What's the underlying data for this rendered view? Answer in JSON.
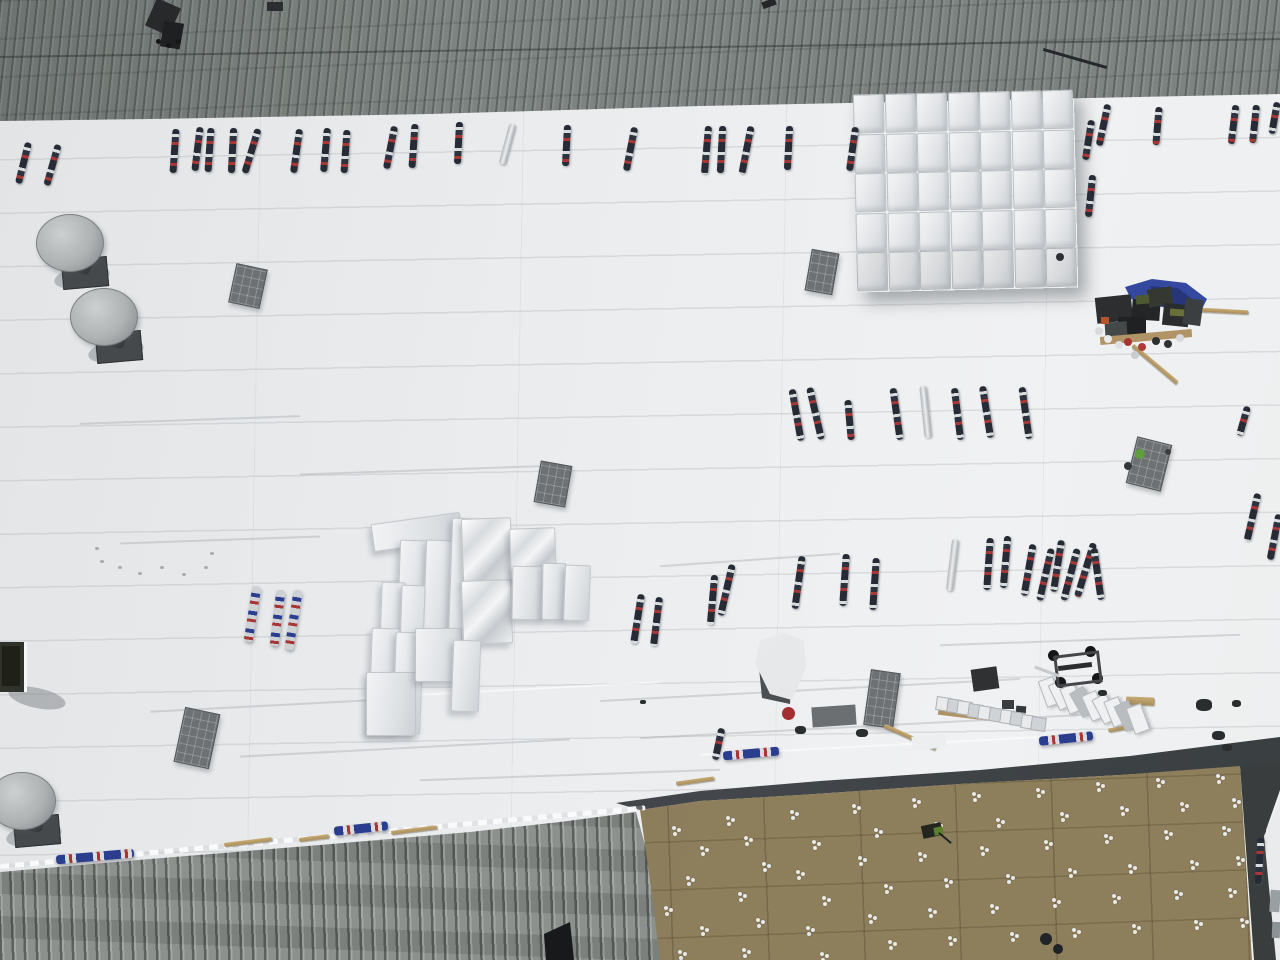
{
  "meta": {
    "view": "aerial-drone-roof-construction",
    "canvas": {
      "w": 1280,
      "h": 960
    }
  },
  "palette": {
    "membrane_white": "#eceeef",
    "metal_gray": "#7d8380",
    "weathered_metal": "#868b88",
    "insulation_tan": "#8d7e5c",
    "dark_membrane": "#3f4344",
    "roll_navy": "#2a3040",
    "roll_red": "#a83434",
    "roll_blue": "#2b3d8f",
    "tarp_blue": "#3448a0",
    "wood_tan": "#b99d66",
    "stack_white": "#eef0f2",
    "pad_gray": "#6d7174",
    "vent_cap_gray": "#b6b9ba",
    "safety_green": "#5f9f3a"
  },
  "scene": {
    "polys": [
      {
        "name": "corrugated-metal-roof-top",
        "pts": "0,0 1280,0 1280,94 1040,99 700,106 430,114 150,119 0,121",
        "cls": "metal-top"
      },
      {
        "name": "corrugated-metal-roof-bottom-left",
        "pts": "0,872 150,859 320,845 470,832 560,822 636,812 648,856 656,900 662,960 0,960",
        "cls": "metal-bottom"
      },
      {
        "name": "dark-membrane-band",
        "pts": "616,803 700,791 820,781 980,770 1130,756 1280,737 1280,765 1120,775 960,784 800,795 700,801 640,810",
        "cls": "dark-band"
      },
      {
        "name": "insulation-board-field",
        "pts": "640,810 700,801 800,795 960,784 1120,775 1240,766 1252,960 660,960 650,880",
        "cls": "tan-field"
      },
      {
        "name": "right-edge-dark-strip",
        "pts": "1240,766 1280,762 1280,790 1266,830 1277,960 1254,960",
        "fill": "#393d3e"
      },
      {
        "name": "right-edge-white-sliver",
        "pts": "1264,836 1280,800 1280,960 1276,960",
        "fill": "#e9ebec"
      },
      {
        "name": "metal-roof-opening",
        "pts": "544,934 570,922 574,960 546,960",
        "fill": "#17191a"
      },
      {
        "name": "white-tarp-shadow",
        "pts": "758,658 792,666 790,704 762,698",
        "fill": "#4b4f51"
      },
      {
        "name": "white-tarp-piece",
        "pts": "760,640 786,633 804,641 806,667 792,700 770,694 755,663",
        "cls": "tarp-light"
      },
      {
        "name": "blue-tarp",
        "pts": "1125,287 1152,279 1186,283 1207,299 1198,317 1172,309 1148,304 1131,299",
        "fill": "#3448a0"
      },
      {
        "name": "blue-tarp-fold",
        "pts": "1150,286 1178,288 1196,302 1180,310 1156,300",
        "fill": "#273579"
      }
    ],
    "streaks": [
      [
        150,
        705,
        260,
        -3
      ],
      [
        240,
        748,
        330,
        -3
      ],
      [
        420,
        775,
        300,
        -2
      ],
      [
        600,
        690,
        420,
        -3
      ],
      [
        640,
        725,
        500,
        -3
      ],
      [
        120,
        540,
        200,
        -2
      ],
      [
        660,
        560,
        180,
        -4
      ],
      [
        940,
        640,
        300,
        -2
      ],
      [
        300,
        470,
        260,
        -2
      ],
      [
        80,
        420,
        220,
        -2
      ]
    ],
    "bright_streaks": [
      [
        360,
        690,
        300,
        -3
      ],
      [
        700,
        745,
        380,
        -3
      ]
    ],
    "rolls": [
      [
        23,
        163,
        42,
        14
      ],
      [
        52,
        165,
        42,
        16
      ],
      [
        174,
        151,
        44,
        4
      ],
      [
        197,
        149,
        44,
        7
      ],
      [
        209,
        150,
        44,
        4
      ],
      [
        232,
        150,
        45,
        3
      ],
      [
        251,
        151,
        46,
        17
      ],
      [
        296,
        151,
        44,
        8
      ],
      [
        325,
        150,
        44,
        5
      ],
      [
        345,
        151,
        43,
        4
      ],
      [
        390,
        147,
        43,
        11
      ],
      [
        413,
        146,
        44,
        4
      ],
      [
        458,
        143,
        42,
        3
      ],
      [
        507,
        144,
        42,
        15,
        "s"
      ],
      [
        566,
        145,
        41,
        3
      ],
      [
        630,
        149,
        44,
        11
      ],
      [
        706,
        150,
        48,
        5
      ],
      [
        721,
        149,
        47,
        3
      ],
      [
        746,
        150,
        48,
        11
      ],
      [
        788,
        148,
        44,
        3
      ],
      [
        852,
        149,
        44,
        8
      ],
      [
        1088,
        140,
        40,
        9
      ],
      [
        1103,
        125,
        42,
        12
      ],
      [
        1090,
        196,
        42,
        6
      ],
      [
        1157,
        126,
        38,
        5
      ],
      [
        1233,
        124,
        39,
        7
      ],
      [
        1254,
        124,
        38,
        6
      ],
      [
        1274,
        118,
        32,
        10
      ],
      [
        796,
        415,
        52,
        -10
      ],
      [
        815,
        413,
        53,
        -13
      ],
      [
        849,
        420,
        40,
        -5
      ],
      [
        896,
        414,
        52,
        -8
      ],
      [
        925,
        412,
        52,
        -6,
        "s"
      ],
      [
        957,
        414,
        52,
        -7
      ],
      [
        986,
        412,
        52,
        -9
      ],
      [
        1025,
        413,
        52,
        -8
      ],
      [
        1243,
        421,
        30,
        16
      ],
      [
        1252,
        517,
        48,
        13
      ],
      [
        1274,
        537,
        46,
        11
      ],
      [
        637,
        619,
        50,
        9
      ],
      [
        656,
        621,
        49,
        7
      ],
      [
        712,
        600,
        50,
        5
      ],
      [
        726,
        590,
        52,
        13
      ],
      [
        798,
        582,
        53,
        8
      ],
      [
        844,
        580,
        52,
        4
      ],
      [
        874,
        584,
        52,
        4
      ],
      [
        952,
        565,
        52,
        7,
        "s"
      ],
      [
        988,
        564,
        52,
        4
      ],
      [
        1005,
        562,
        52,
        5
      ],
      [
        1028,
        570,
        52,
        10
      ],
      [
        1045,
        574,
        53,
        13
      ],
      [
        1057,
        566,
        52,
        9
      ],
      [
        1070,
        574,
        53,
        15
      ],
      [
        1085,
        570,
        56,
        17
      ],
      [
        1097,
        574,
        52,
        -8
      ],
      [
        252,
        614,
        56,
        9,
        "sl"
      ],
      [
        277,
        618,
        56,
        7,
        "sl"
      ],
      [
        293,
        620,
        60,
        9,
        "sl"
      ],
      [
        718,
        744,
        32,
        12
      ],
      [
        751,
        753,
        56,
        -5,
        "tpo"
      ],
      [
        1066,
        738,
        54,
        -6,
        "tpo"
      ],
      [
        95,
        856,
        78,
        -5,
        "tpo"
      ],
      [
        361,
        828,
        54,
        -6,
        "tpo"
      ],
      [
        1259,
        861,
        46,
        4
      ]
    ],
    "pads": [
      [
        232,
        266,
        30,
        38,
        12
      ],
      [
        808,
        251,
        26,
        40,
        10
      ],
      [
        537,
        463,
        30,
        40,
        10
      ],
      [
        179,
        710,
        34,
        54,
        12
      ],
      [
        867,
        671,
        28,
        54,
        8
      ],
      [
        1131,
        440,
        34,
        46,
        14
      ]
    ],
    "vents": [
      [
        36,
        214
      ],
      [
        70,
        288
      ],
      [
        -12,
        772
      ]
    ],
    "stack_large": {
      "x": 855,
      "y": 92,
      "cols": 7,
      "rows": 5,
      "cw": 29,
      "ch": 37,
      "gx": 31.5,
      "gy": 39.5,
      "rot": -1.3
    },
    "stack_mid": [
      [
        372,
        518,
        88,
        26,
        -8,
        "b"
      ],
      [
        398,
        540,
        26,
        118,
        2,
        "b"
      ],
      [
        424,
        540,
        26,
        116,
        2,
        "b"
      ],
      [
        450,
        518,
        26,
        122,
        2,
        "b"
      ],
      [
        380,
        582,
        22,
        96,
        2,
        "b"
      ],
      [
        400,
        585,
        22,
        94,
        2,
        "b"
      ],
      [
        370,
        628,
        26,
        104,
        2,
        "b"
      ],
      [
        394,
        632,
        26,
        100,
        2,
        "b"
      ],
      [
        366,
        672,
        48,
        62,
        0,
        "b"
      ],
      [
        415,
        628,
        45,
        52,
        0,
        "b"
      ],
      [
        462,
        518,
        48,
        62,
        -2,
        "sh"
      ],
      [
        462,
        580,
        48,
        62,
        -2,
        "sh"
      ],
      [
        510,
        528,
        44,
        50,
        -2,
        "sh"
      ],
      [
        512,
        566,
        30,
        52,
        1,
        "b"
      ],
      [
        542,
        563,
        22,
        55,
        1,
        "b"
      ],
      [
        564,
        565,
        24,
        54,
        2,
        "b"
      ],
      [
        452,
        640,
        26,
        70,
        2,
        "b"
      ]
    ],
    "fasteners": [
      [
        672,
        826
      ],
      [
        700,
        846
      ],
      [
        686,
        876
      ],
      [
        664,
        906
      ],
      [
        700,
        926
      ],
      [
        678,
        950
      ],
      [
        726,
        816
      ],
      [
        744,
        836
      ],
      [
        762,
        862
      ],
      [
        738,
        892
      ],
      [
        756,
        918
      ],
      [
        742,
        948
      ],
      [
        790,
        810
      ],
      [
        812,
        840
      ],
      [
        796,
        870
      ],
      [
        822,
        896
      ],
      [
        806,
        926
      ],
      [
        820,
        952
      ],
      [
        852,
        804
      ],
      [
        874,
        828
      ],
      [
        858,
        856
      ],
      [
        884,
        884
      ],
      [
        868,
        914
      ],
      [
        888,
        940
      ],
      [
        912,
        798
      ],
      [
        934,
        822
      ],
      [
        918,
        852
      ],
      [
        944,
        878
      ],
      [
        928,
        908
      ],
      [
        948,
        936
      ],
      [
        972,
        792
      ],
      [
        996,
        818
      ],
      [
        980,
        846
      ],
      [
        1006,
        874
      ],
      [
        990,
        904
      ],
      [
        1010,
        932
      ],
      [
        1036,
        788
      ],
      [
        1060,
        812
      ],
      [
        1044,
        840
      ],
      [
        1068,
        868
      ],
      [
        1052,
        898
      ],
      [
        1072,
        928
      ],
      [
        1096,
        782
      ],
      [
        1120,
        806
      ],
      [
        1104,
        834
      ],
      [
        1128,
        864
      ],
      [
        1112,
        894
      ],
      [
        1132,
        924
      ],
      [
        1156,
        778
      ],
      [
        1180,
        802
      ],
      [
        1164,
        830
      ],
      [
        1190,
        860
      ],
      [
        1174,
        890
      ],
      [
        1194,
        920
      ],
      [
        1216,
        774
      ],
      [
        1232,
        798
      ],
      [
        1222,
        826
      ],
      [
        1236,
        856
      ],
      [
        1228,
        888
      ],
      [
        1240,
        918
      ]
    ],
    "planks": [
      [
        248,
        842,
        48,
        -7,
        4
      ],
      [
        314,
        838,
        30,
        -7,
        4
      ],
      [
        414,
        830,
        46,
        -7,
        4
      ],
      [
        695,
        781,
        38,
        -8,
        4
      ],
      [
        910,
        737,
        56,
        24,
        4
      ],
      [
        1140,
        701,
        28,
        2,
        8
      ],
      [
        1155,
        364,
        58,
        40,
        4
      ],
      [
        1224,
        311,
        48,
        3,
        4
      ],
      [
        1128,
        727,
        40,
        -10,
        4
      ]
    ],
    "sticks": [
      [
        1075,
        58,
        66,
        16,
        3,
        "#25282a"
      ]
    ],
    "equipment": [
      [
        1096,
        296,
        36,
        26,
        -6,
        "#2c2e30"
      ],
      [
        1132,
        300,
        28,
        20,
        4,
        "#232527"
      ],
      [
        1148,
        288,
        24,
        18,
        -8,
        "#343830"
      ],
      [
        1163,
        304,
        26,
        22,
        6,
        "#2a2c2e"
      ],
      [
        1118,
        317,
        28,
        18,
        0,
        "#1f2123"
      ],
      [
        1184,
        299,
        18,
        26,
        8,
        "#3c3f42"
      ],
      [
        1105,
        322,
        22,
        14,
        -4,
        "#454849"
      ],
      [
        1136,
        295,
        13,
        9,
        -6,
        "#4e5a31"
      ],
      [
        1170,
        309,
        14,
        7,
        4,
        "#6b703b"
      ],
      [
        1101,
        317,
        8,
        7,
        0,
        "#b5542c"
      ],
      [
        1100,
        333,
        92,
        8,
        -5,
        "#b09465"
      ]
    ],
    "misc_rects": [
      [
        972,
        668,
        26,
        22,
        -8,
        "#2f3132"
      ],
      [
        1002,
        700,
        12,
        9,
        0,
        "#3a3d3f"
      ],
      [
        1016,
        706,
        10,
        8,
        4,
        "#36393b"
      ],
      [
        912,
        735,
        34,
        14,
        -6,
        "#eceeef"
      ],
      [
        938,
        712,
        105,
        9,
        7,
        "#ad9264"
      ],
      [
        812,
        706,
        44,
        20,
        -4,
        "#6b6f72"
      ],
      [
        1270,
        890,
        10,
        22,
        4,
        "#9aa0a2"
      ],
      [
        1272,
        922,
        8,
        16,
        2,
        "#8d9395"
      ],
      [
        150,
        2,
        26,
        30,
        24,
        "#27292b"
      ],
      [
        162,
        22,
        20,
        26,
        10,
        "#1e2021"
      ],
      [
        267,
        2,
        16,
        9,
        0,
        "#2b2e30"
      ],
      [
        762,
        0,
        14,
        7,
        -20,
        "#232527"
      ]
    ],
    "boxes_row": {
      "x": 936,
      "y": 697,
      "n": 10,
      "dx": 10.6,
      "dy": 2.2,
      "w": 13,
      "h": 12,
      "rot": 8
    },
    "bundles_row": {
      "x": 1042,
      "y": 678,
      "n": 9,
      "dx": 11,
      "dy": 3.4,
      "w": 14,
      "h": 26,
      "rots": [
        -20,
        -26,
        -22,
        -30,
        -24,
        -28,
        -22,
        -26,
        -20
      ],
      "gray_idx": [
        3,
        7
      ]
    },
    "cart": {
      "x": 1075,
      "y": 666
    },
    "machine": {
      "x": 932,
      "y": 824
    },
    "hatch": {
      "x": 0,
      "y": 642
    },
    "dots": [
      [
        1140,
        454,
        10,
        "#5f9f3a"
      ],
      [
        1128,
        466,
        8,
        "#33373a"
      ],
      [
        1168,
        452,
        6,
        "#3a3e41"
      ],
      [
        1060,
        257,
        8,
        "#2e3133"
      ],
      [
        1046,
        939,
        12,
        "#222527"
      ],
      [
        1058,
        949,
        10,
        "#1f2224"
      ],
      [
        1108,
        339,
        8,
        "#e8eaec"
      ],
      [
        1119,
        345,
        8,
        "#dfe2e4"
      ],
      [
        1128,
        342,
        8,
        "#a83434"
      ],
      [
        1142,
        347,
        8,
        "#b03a3a"
      ],
      [
        1156,
        341,
        8,
        "#2c2e2f"
      ],
      [
        1099,
        331,
        8,
        "#d8dadc"
      ],
      [
        1135,
        355,
        8,
        "#caccce"
      ],
      [
        1168,
        344,
        8,
        "#2f3132"
      ],
      [
        1180,
        338,
        8,
        "#d6d8da"
      ],
      [
        788,
        713,
        13,
        "#a23030"
      ],
      [
        158,
        41,
        5,
        "#141516"
      ],
      [
        168,
        45,
        5,
        "#141516"
      ],
      [
        178,
        41,
        5,
        "#141516"
      ]
    ],
    "specks": [
      [
        795,
        726,
        11,
        8
      ],
      [
        856,
        729,
        12,
        8
      ],
      [
        1196,
        699,
        16,
        12
      ],
      [
        1212,
        731,
        13,
        9
      ],
      [
        1222,
        744,
        10,
        7
      ],
      [
        1232,
        700,
        9,
        7
      ],
      [
        1098,
        690,
        9,
        6
      ],
      [
        640,
        700,
        6,
        4
      ]
    ],
    "smudges": [
      [
        100,
        560
      ],
      [
        118,
        566
      ],
      [
        138,
        572
      ],
      [
        160,
        566
      ],
      [
        182,
        573
      ],
      [
        204,
        566
      ],
      [
        95,
        547
      ],
      [
        210,
        552
      ]
    ],
    "metal_top_seam": {
      "x": 0,
      "y": 48,
      "len": 1282,
      "rot": -0.8
    },
    "boundary_dash": {
      "x": 0,
      "y": 864,
      "len": 648,
      "rot": -5.2
    }
  }
}
